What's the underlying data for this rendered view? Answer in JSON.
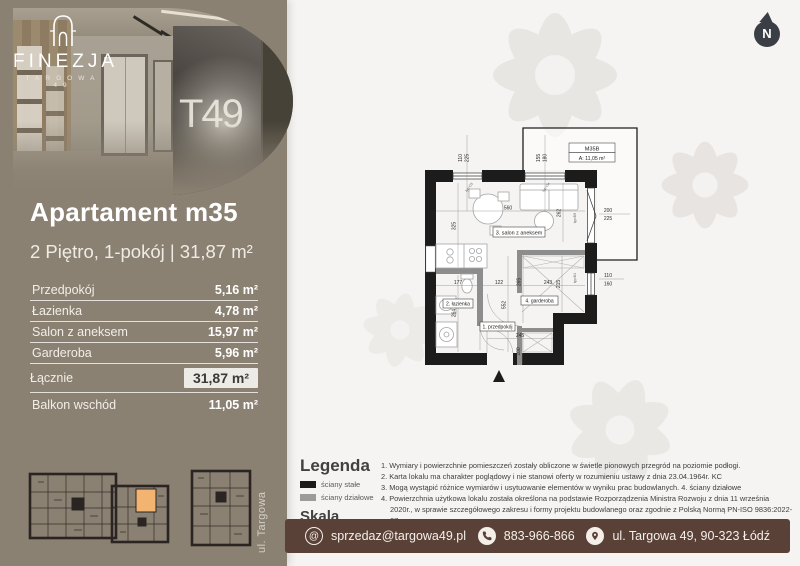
{
  "brand": {
    "name": "FINEZJA",
    "sub": "TARGOWA 49",
    "mural": "T49"
  },
  "compass": {
    "label": "N"
  },
  "listing": {
    "title": "Apartament m35",
    "subtitle": "2 Piętro, 1-pokój | 31,87 m²",
    "rows": [
      {
        "label": "Przedpokój",
        "value": "5,16 m²"
      },
      {
        "label": "Łazienka",
        "value": "4,78 m²"
      },
      {
        "label": "Salon z aneksem",
        "value": "15,97 m²"
      },
      {
        "label": "Garderoba",
        "value": "5,96 m²"
      }
    ],
    "total_row": {
      "label": "Łącznie",
      "value": "31,87 m²"
    },
    "balcony_row": {
      "label": "Balkon wschód",
      "value": "11,05 m²"
    }
  },
  "street_label": "ul. Targowa",
  "legend": {
    "title": "Legenda",
    "items": [
      {
        "label": "ściany stałe",
        "color": "#1d1b19"
      },
      {
        "label": "ściany działowe",
        "color": "#9b9b9b"
      }
    ],
    "scale": "Skala 1:100"
  },
  "notes": [
    "1. Wymiary i powierzchnie pomieszczeń zostały obliczone w świetle pionowych przegród na poziomie podłogi.",
    "2. Karta lokalu ma charakter poglądowy i nie stanowi oferty w rozumieniu ustawy z dnia 23.04.1964r. KC",
    "3. Mogą wystąpić różnice wymiarów i usytuowanie elementów w wyniku prac budowlanych. 4. ściany działowe",
    "4. Powierzchnia użytkowa lokalu została określona na podstawie Rozporządzenia Ministra Rozwoju z dnia 11 września 2020r., w sprawie szczegółowego zakresu i formy projektu budowlanego oraz zgodnie z Polską Normą PN-ISO 9836:2022-07"
  ],
  "contact": {
    "email": "sprzedaz@targowa49.pl",
    "phone": "883-966-866",
    "address": "ul. Targowa 49, 90-323 Łódź"
  },
  "floorplan": {
    "balcony_tag": {
      "id": "M35B",
      "area": "A: 11,05 m²"
    },
    "room_labels": [
      "1. przedpokój",
      "2. łazienka",
      "3. salon z aneksem",
      "4. garderoba"
    ],
    "dims": {
      "salon_w": "560",
      "salon_h": "325",
      "salon_d": "262",
      "hall_h": "552",
      "bath_w": "177",
      "hall_w": "122",
      "gard_d": "265",
      "gard_w": "243",
      "gard_h": "215",
      "bath_h": "264",
      "entry_w": "245",
      "entry_d": "100"
    },
    "win_dims": [
      [
        "110",
        "225"
      ],
      [
        "155",
        "180"
      ],
      [
        "200",
        "225"
      ],
      [
        "110",
        "160"
      ]
    ],
    "typ_labels": [
      "typ:O3",
      "typ:O4",
      "typ:B9",
      "typ:B4"
    ]
  },
  "colors": {
    "panel": "#8b8173",
    "bar": "#5a4138",
    "highlight_unit": "#f4b471"
  }
}
